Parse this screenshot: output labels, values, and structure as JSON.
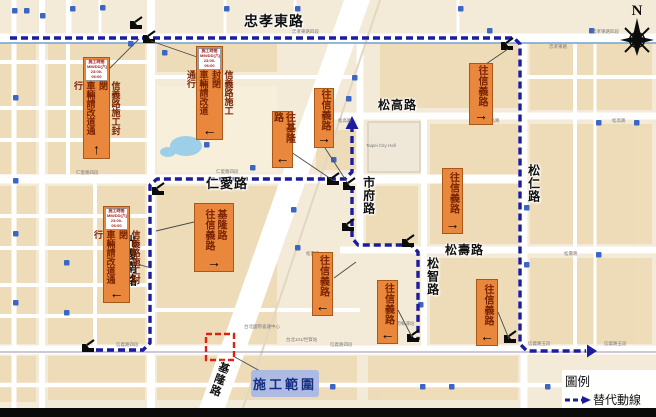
{
  "colors": {
    "route": "#1c1c9e",
    "banner_bg": "#e9873c",
    "banner_text": "#7a2300",
    "zone_border": "#dd2211",
    "zone_label_bg": "#a7b6e4",
    "zone_label_text": "#162e83"
  },
  "compass": {
    "north": "N"
  },
  "legend": {
    "title": "圖例",
    "alt_route": "替代動線"
  },
  "construction": {
    "label": "施工範圍",
    "box": {
      "x": 206,
      "y": 334,
      "w": 28,
      "h": 26
    }
  },
  "road_labels": [
    {
      "t": "忠孝東路",
      "x": 244,
      "y": 14,
      "v": false,
      "fs": 14
    },
    {
      "t": "仁愛路",
      "x": 206,
      "y": 177,
      "v": false,
      "fs": 13
    },
    {
      "t": "松高路",
      "x": 378,
      "y": 99,
      "v": false,
      "fs": 12
    },
    {
      "t": "松壽路",
      "x": 445,
      "y": 244,
      "v": false,
      "fs": 12
    },
    {
      "t": "市府路",
      "x": 362,
      "y": 176,
      "v": true,
      "fs": 12
    },
    {
      "t": "松智路",
      "x": 426,
      "y": 257,
      "v": true,
      "fs": 12
    },
    {
      "t": "松仁路",
      "x": 527,
      "y": 164,
      "v": true,
      "fs": 12
    },
    {
      "t": "光復南路",
      "x": 124,
      "y": 235,
      "v": true,
      "fs": 12
    },
    {
      "t": "基隆路",
      "x": 219,
      "y": 360,
      "v": true,
      "fs": 11,
      "rot": 20
    }
  ],
  "small_labels": [
    {
      "t": "忠孝東路四段",
      "x": 292,
      "y": 29
    },
    {
      "t": "忠孝東路",
      "x": 549,
      "y": 44
    },
    {
      "t": "忠孝東路四段",
      "x": 592,
      "y": 29
    },
    {
      "t": "仁愛路四段",
      "x": 76,
      "y": 170
    },
    {
      "t": "仁愛路四段",
      "x": 216,
      "y": 169
    },
    {
      "t": "信義路四段",
      "x": 116,
      "y": 342
    },
    {
      "t": "信義路四段",
      "x": 330,
      "y": 342
    },
    {
      "t": "信義路五段",
      "x": 528,
      "y": 341
    },
    {
      "t": "信義路五段",
      "x": 604,
      "y": 341
    },
    {
      "t": "松高路",
      "x": 338,
      "y": 118
    },
    {
      "t": "松高路",
      "x": 486,
      "y": 118
    },
    {
      "t": "松高路",
      "x": 612,
      "y": 118
    },
    {
      "t": "松壽路",
      "x": 306,
      "y": 251
    },
    {
      "t": "松壽路",
      "x": 564,
      "y": 251
    },
    {
      "t": "Taipei City Hall",
      "x": 366,
      "y": 143
    },
    {
      "t": "台北國際會議中心",
      "x": 244,
      "y": 324
    },
    {
      "t": "市府轉運站",
      "x": 392,
      "y": 321
    },
    {
      "t": "台北101/世貿站",
      "x": 286,
      "y": 337
    }
  ],
  "banners": [
    {
      "kind": "closure",
      "header": [
        "施工時間",
        "MM/DD(六)",
        "23:00-06:00"
      ],
      "text": "信義路施工封閉\n車輛請改道通行",
      "arrow": "up",
      "x": 83,
      "y": 57,
      "w": 27,
      "h": 102
    },
    {
      "kind": "closure",
      "header": [
        "施工時間",
        "MM/DD(六)",
        "23:00-06:00"
      ],
      "text": "信義路施工封閉\n車輛請改道通行",
      "arrow": "left",
      "x": 196,
      "y": 46,
      "w": 27,
      "h": 94
    },
    {
      "kind": "closure",
      "header": [
        "施工時間",
        "MM/DD(六)",
        "23:00-06:00"
      ],
      "text": "信義路施工封閉\n車輛請改道通行",
      "arrow": "left",
      "x": 103,
      "y": 206,
      "w": 27,
      "h": 97
    },
    {
      "kind": "dir",
      "text": "往基隆路",
      "arrow": "left",
      "x": 272,
      "y": 111,
      "w": 21,
      "h": 57
    },
    {
      "kind": "dir",
      "text": "往信義路",
      "arrow": "right",
      "x": 314,
      "y": 88,
      "w": 20,
      "h": 60
    },
    {
      "kind": "dir",
      "text": "基隆路\n往信義路",
      "arrow": "right",
      "x": 194,
      "y": 203,
      "w": 40,
      "h": 69
    },
    {
      "kind": "dir",
      "text": "往信義路",
      "arrow": "left",
      "x": 312,
      "y": 252,
      "w": 21,
      "h": 64
    },
    {
      "kind": "dir",
      "text": "往信義路",
      "arrow": "left",
      "x": 377,
      "y": 280,
      "w": 21,
      "h": 64
    },
    {
      "kind": "dir",
      "text": "往信義路",
      "arrow": "right",
      "x": 469,
      "y": 63,
      "w": 24,
      "h": 62
    },
    {
      "kind": "dir",
      "text": "往信義路",
      "arrow": "right",
      "x": 442,
      "y": 168,
      "w": 21,
      "h": 66
    },
    {
      "kind": "dir",
      "text": "往信義路",
      "arrow": "left",
      "x": 476,
      "y": 279,
      "w": 22,
      "h": 67
    }
  ],
  "routes": [
    {
      "name": "north-east-detour",
      "points": [
        [
          10,
          38
        ],
        [
          514,
          38
        ],
        [
          520,
          44
        ],
        [
          520,
          344
        ],
        [
          527,
          351
        ],
        [
          586,
          351
        ]
      ],
      "end_arrow": "right"
    },
    {
      "name": "west-loop-detour",
      "points": [
        [
          96,
          350
        ],
        [
          143,
          350
        ],
        [
          150,
          343
        ],
        [
          150,
          185
        ],
        [
          157,
          179
        ],
        [
          345,
          179
        ],
        [
          352,
          172
        ],
        [
          352,
          128
        ]
      ],
      "end_arrow": "up"
    },
    {
      "name": "mid-branch-detour",
      "points": [
        [
          352,
          186
        ],
        [
          352,
          238
        ],
        [
          358,
          245
        ],
        [
          411,
          245
        ],
        [
          418,
          252
        ],
        [
          418,
          340
        ]
      ],
      "end_arrow": null
    }
  ],
  "closure_icons": [
    [
      136,
      26
    ],
    [
      149,
      40
    ],
    [
      507,
      47
    ],
    [
      88,
      349
    ],
    [
      158,
      192
    ],
    [
      333,
      182
    ],
    [
      349,
      187
    ],
    [
      348,
      228
    ],
    [
      408,
      244
    ],
    [
      413,
      339
    ],
    [
      510,
      340
    ]
  ],
  "leader_lines": [
    [
      108,
      70,
      139,
      39
    ],
    [
      197,
      57,
      151,
      41
    ],
    [
      130,
      262,
      151,
      268
    ],
    [
      288,
      150,
      334,
      181
    ],
    [
      325,
      148,
      347,
      182
    ],
    [
      194,
      222,
      156,
      231
    ],
    [
      486,
      64,
      508,
      49
    ],
    [
      334,
      278,
      356,
      262
    ],
    [
      398,
      310,
      412,
      337
    ],
    [
      498,
      312,
      509,
      339
    ],
    [
      233,
      356,
      260,
      371
    ]
  ],
  "metro_markers": [
    [
      12,
      8
    ],
    [
      24,
      8
    ],
    [
      40,
      13
    ],
    [
      70,
      6
    ],
    [
      100,
      5
    ],
    [
      128,
      41
    ],
    [
      162,
      50
    ],
    [
      224,
      6
    ],
    [
      295,
      6
    ],
    [
      458,
      6
    ],
    [
      487,
      28
    ],
    [
      589,
      28
    ],
    [
      13,
      95
    ],
    [
      13,
      178
    ],
    [
      13,
      231
    ],
    [
      13,
      300
    ],
    [
      352,
      75
    ],
    [
      346,
      96
    ],
    [
      331,
      157
    ],
    [
      524,
      205
    ],
    [
      524,
      262
    ],
    [
      418,
      302
    ],
    [
      295,
      245
    ],
    [
      291,
      207
    ],
    [
      330,
      384
    ],
    [
      420,
      384
    ],
    [
      449,
      384
    ],
    [
      545,
      384
    ],
    [
      64,
      260
    ],
    [
      64,
      310
    ],
    [
      204,
      142
    ],
    [
      250,
      165
    ],
    [
      596,
      120
    ],
    [
      634,
      120
    ],
    [
      596,
      252
    ]
  ]
}
